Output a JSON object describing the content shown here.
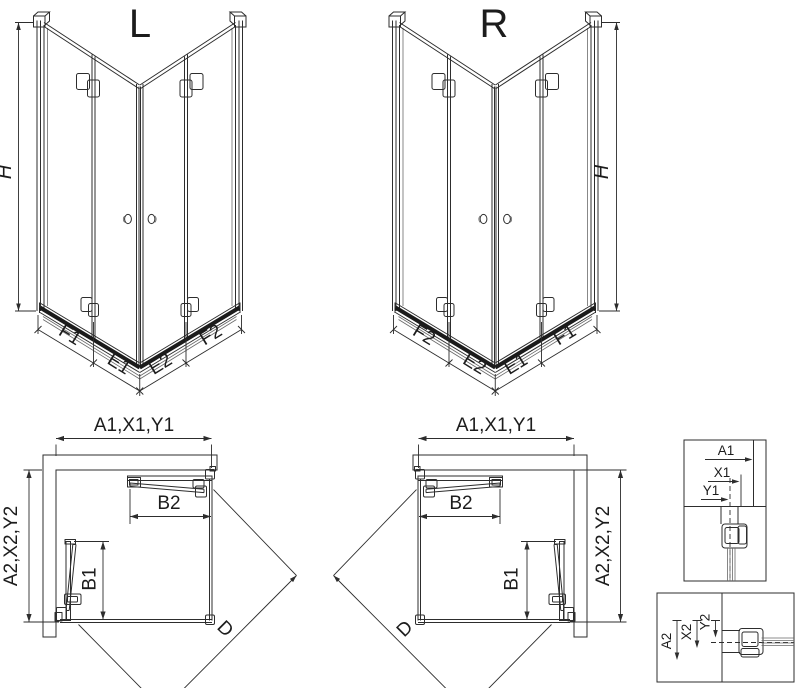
{
  "drawing": {
    "iso_left": {
      "title": "L",
      "height_label": "H",
      "edge_labels": [
        "F1",
        "E1",
        "E2",
        "F2"
      ]
    },
    "iso_right": {
      "title": "R",
      "height_label": "H",
      "edge_labels": [
        "F2",
        "E2",
        "E1",
        "F1"
      ]
    },
    "plan_left": {
      "width_label": "A1,X1,Y1",
      "depth_label": "A2,X2,Y2",
      "entry_top_label": "B2",
      "entry_side_label": "B1",
      "diagonal_label": "D"
    },
    "plan_right": {
      "width_label": "A1,X1,Y1",
      "depth_label": "A2,X2,Y2",
      "entry_top_label": "B2",
      "entry_side_label": "B1",
      "diagonal_label": "D"
    },
    "detail_profile_top": {
      "labels": [
        "A1",
        "X1",
        "Y1"
      ]
    },
    "detail_profile_side": {
      "labels": [
        "A2",
        "X2",
        "Y2"
      ]
    },
    "colors": {
      "line": "#2d2d2d",
      "rail": "#1b1b1b",
      "text": "#1c1c1c",
      "background": "#ffffff"
    }
  }
}
